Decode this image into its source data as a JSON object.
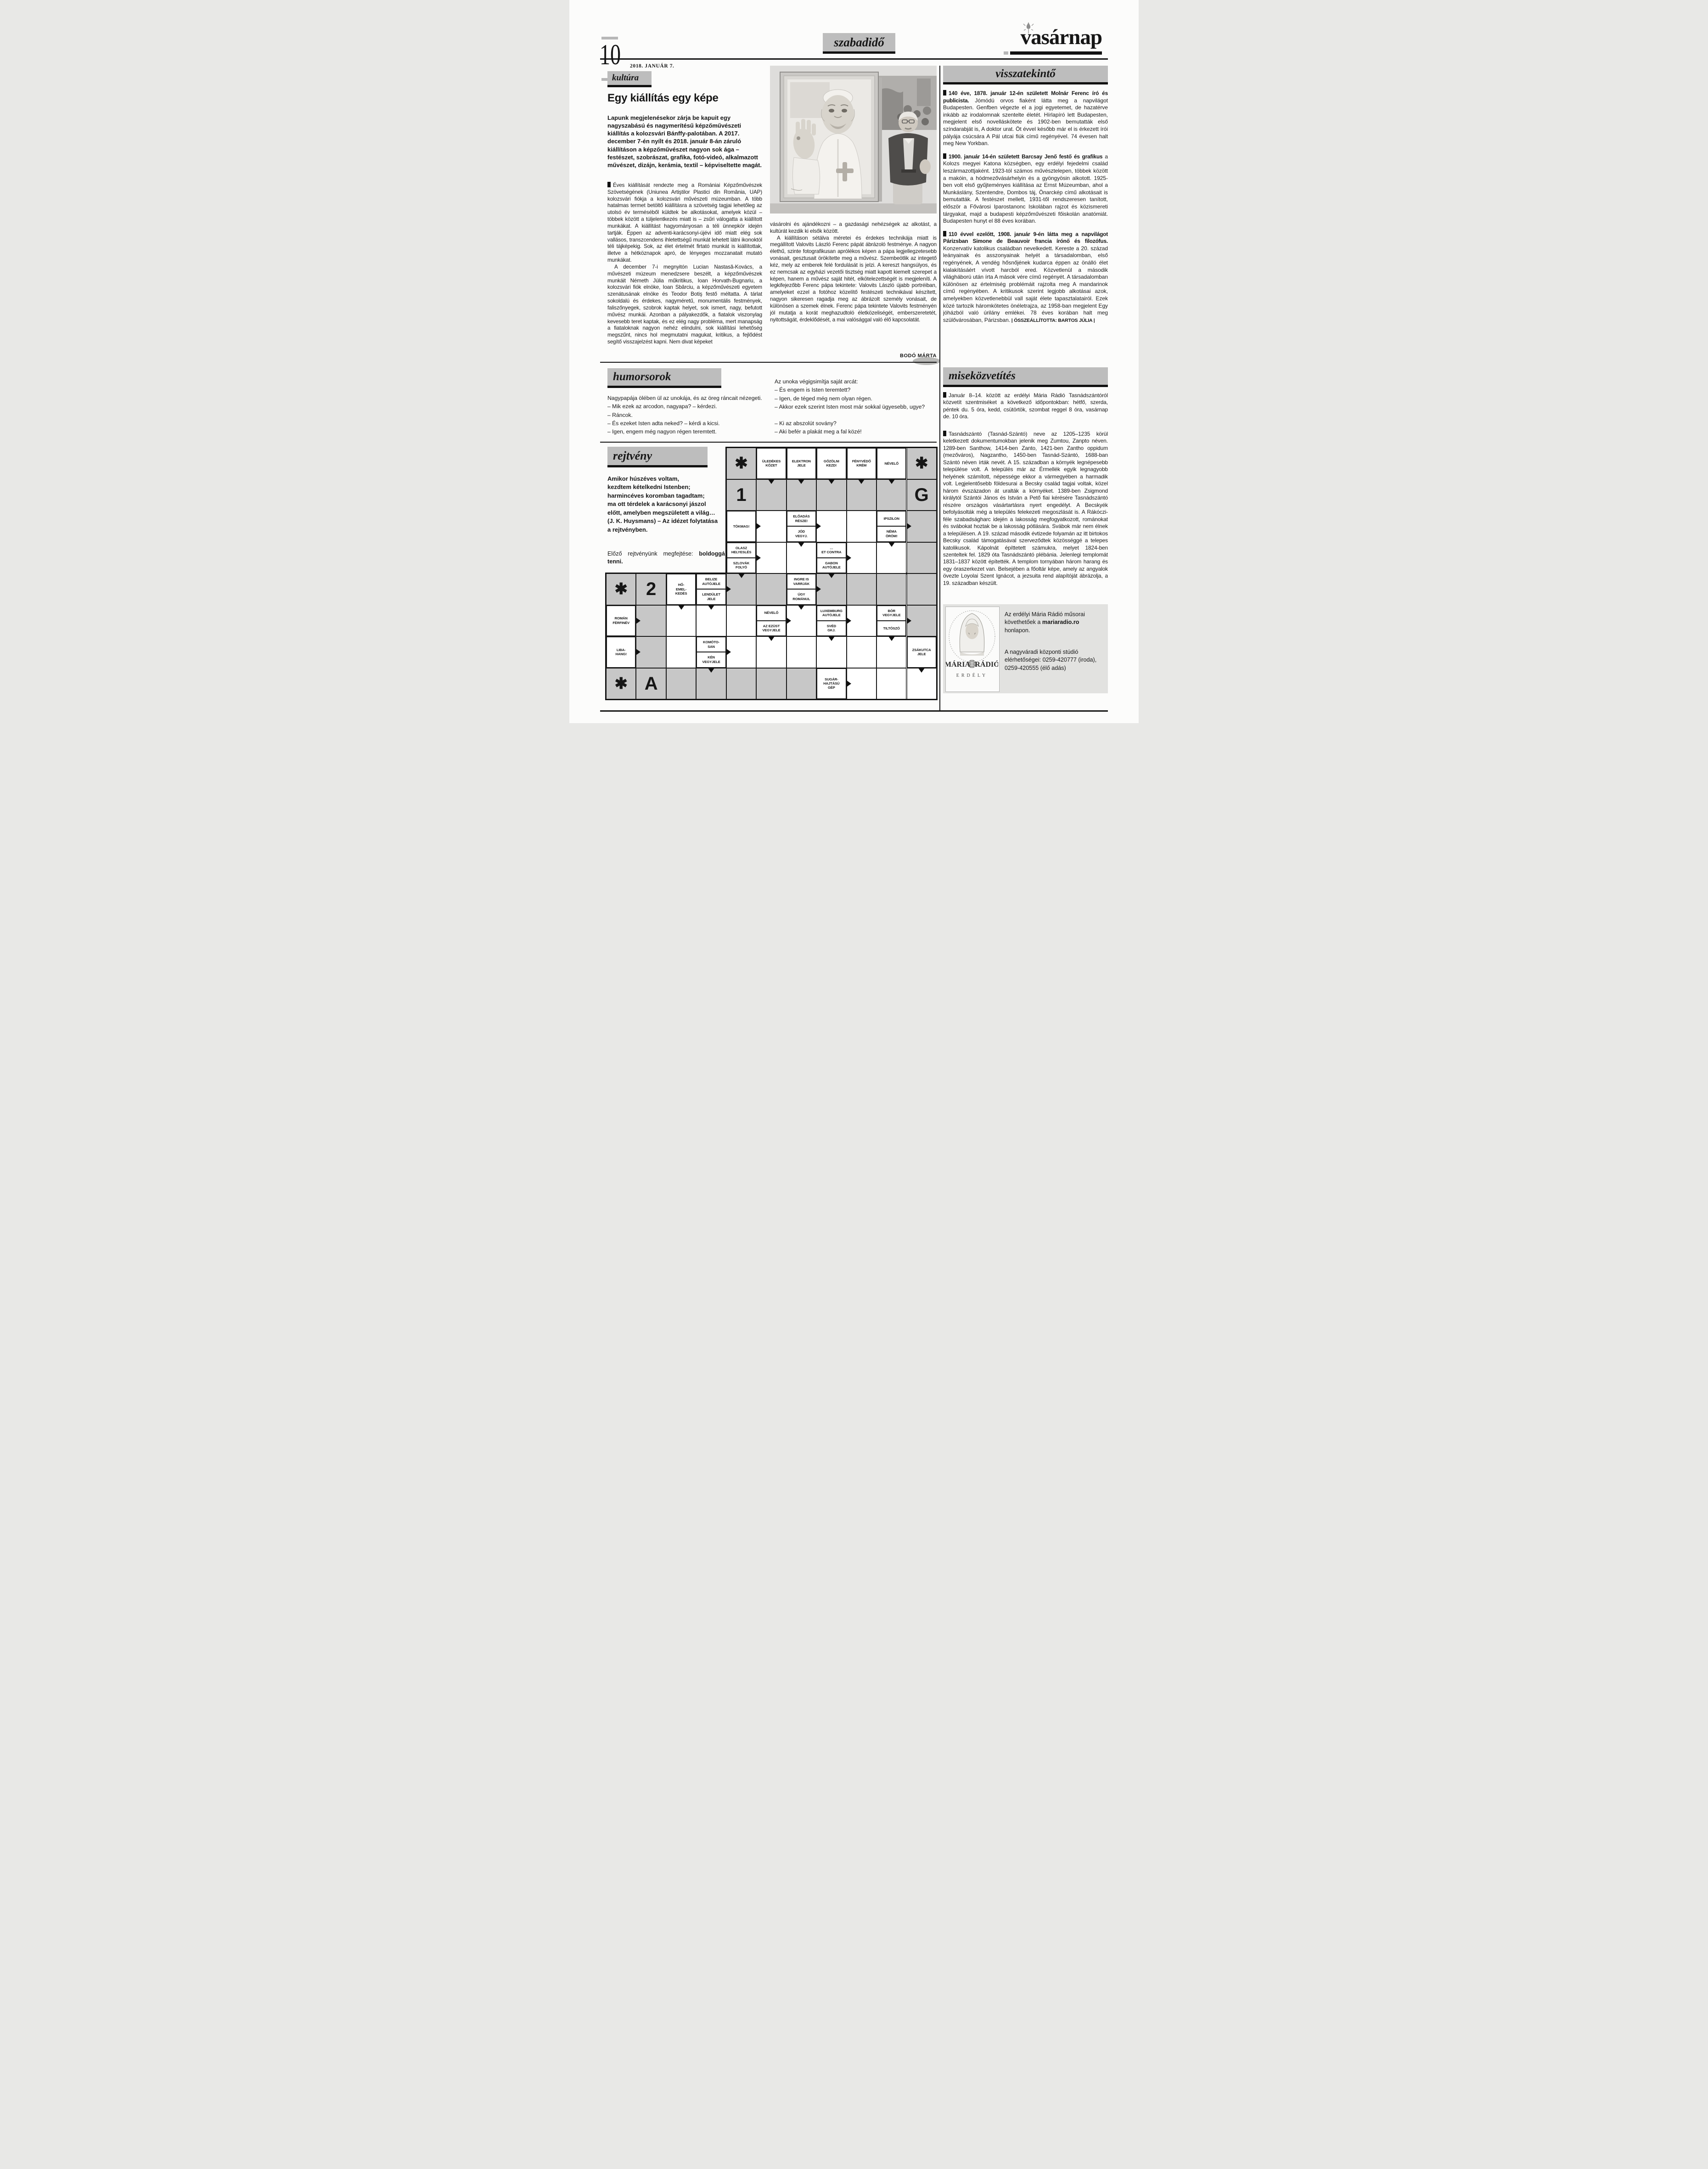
{
  "colors": {
    "header_gray": "#bdbdbd",
    "box_gray": "#d9d9d7",
    "solution_gray": "#c7c7c7",
    "ink": "#161616",
    "paper": "#fcfcfb"
  },
  "header": {
    "page_number": "10",
    "date": "2018. JANUÁR 7.",
    "section_label": "szabadidő",
    "masthead": "vasárnap"
  },
  "article": {
    "label": "kultúra",
    "title": "Egy kiállítás egy képe",
    "lead": "Lapunk megjelenésekor zárja be kapuit egy nagyszabású és nagymerítésű képzőművészeti kiállítás a kolozsvári Bánffy-palotában. A 2017. december 7-én nyílt és 2018. január 8-án záruló kiállításon a képzőművészet nagyon sok ága – festészet, szobrászat, grafika, fotó-videó, alkalmazott művészet, dizájn, kerámia, textil – képviseltette magát.",
    "body1a": "Éves kiállítását rendezte meg a Romániai Képzőművészek Szövetségének (Uniunea Artiştilor Plastici din România, UAP) kolozsvári fiókja a kolozsvári művészeti múzeumban. A több hatalmas termet betöltő kiállításra a szövetség tagjai lehetőleg az utolsó év terméséből küldtek be alkotásokat, amelyek közül – többek között a túljelentkezés miatt is – zsűri válogatta a kiállított munkákat. A kiállítást hagyományosan a téli ünnepkör idején tartják. Éppen az adventi-karácsonyi-újévi idő miatt elég sok vallásos, transzcendens ihletettségű munkát lehetett látni ikonoktól téli tájképekig. Sok, az élet értelmét firtató munkát is kiállítottak, illetve a hétköznapok apró, de lényeges mozzanatait mutató munkákat.",
    "body1b": "A december 7-i megnyitón Lucian Nastasă-Kovács, a művészeti múzeum menedzsere beszélt, a képzőművészek munkáit Németh Júlia műkritikus, Ioan Horvath-Bugnariu, a kolozsvári fiók elnöke, Ioan Sbârciu, a képzőművészeti egyetem szenátusának elnöke és Teodor Botiş festő méltatta. A tárlat sokoldalú és érdekes, nagyméretű, monumentális festmények, faliszőnyegek, szobrok kaptak helyet, sok ismert, nagy, befutott művész munkái. Azonban a pályakezdők, a fiatalok viszonylag kevesebb teret kaptak, és ez elég nagy probléma, mert manapság a fiataloknak nagyon nehéz elindulni, sok kiállítási lehetőség megszűnt, nincs hol megmutatni magukat, kritikus, a fejlődést segítő visszajelzést kapni. Nem divat képeket",
    "body2a": "vásárolni és ajándékozni – a gazdasági nehézségek az alkotást, a kultúrát kezdik ki elsők között.",
    "body2b": "A kiállításon sétálva méretei és érdekes technikája miatt is megállított Valovits László Ferenc pápát ábrázoló festménye. A nagyon élethű, szinte fotografikusan aprólékos képen a pápa legjellegzetesebb vonásait, gesztusait örökítette meg a művész. Szembeötlik az integető kéz, mely az emberek felé fordulását is jelzi. A kereszt hangsúlyos, és ez nemcsak az egyházi vezetői tisztség miatt kapott kiemelt szerepet a képen, hanem a művész saját hitét, elkötelezettségét is megjeleníti. A legkifejezőbb Ferenc pápa tekintete: Valovits László újabb portréiban, amelyeket ezzel a fotóhoz közelítő festészeti technikával készített, nagyon sikeresen ragadja meg az ábrázolt személy vonásait, de különösen a szemek élnek. Ferenc pápa tekintete Valovits festményén jól mutatja a korát meghazudtoló életközeliségét, emberszeretetét, nyitottságát, érdeklődését, a mai valósággal való élő kapcsolatát.",
    "byline": "BODÓ MÁRTA"
  },
  "visszatekinto": {
    "label": "visszatekintő",
    "items": [
      {
        "bold": "140 éve, 1878. január 12-én született Molnár Ferenc író és publicista.",
        "text": " Jómódú orvos fiaként látta meg a napvilágot Budapesten. Genfben végezte el a jogi egyetemet, de hazatérve inkább az irodalomnak szentelte életét. Hírlapíró lett Budapesten, megjelent első novelláskötete és 1902-ben bemutatták első színdarabját is, A doktor urat. Öt évvel később már el is érkezett írói pályája csúcsára A Pál utcai fiúk című regényével. 74 évesen halt meg New Yorkban."
      },
      {
        "bold": "1900. január 14-én született Barcsay Jenő festő és grafikus",
        "text": " a Kolozs megyei Katona községben, egy erdélyi fejedelmi család leszármazottjaként. 1923-tól számos művésztelepen, többek között a makóin, a hódmezővásárhelyin és a gyöngyösin alkotott. 1925-ben volt első gyűjteményes kiállítása az Ernst Múzeumban, ahol a Munkáslány, Szentendre, Dombos táj, Önarckép című alkotásait is bemutatták. A festészet mellett, 1931-től rendszeresen tanított, először a Fővárosi Iparostanonc Iskolában rajzot és közismereti tárgyakat, majd a budapesti képzőművészeti főiskolán anatómiát. Budapesten hunyt el 88 éves korában."
      },
      {
        "bold": "110 évvel ezelőtt, 1908. január 9-én látta meg a napvilágot Párizsban Simone de Beauvoir francia írónő és filozófus.",
        "text": " Konzervatív katolikus családban nevelkedett. Kereste a 20. század leányainak és asszonyainak helyét a társadalomban, első regényének, A vendég hősnőjének kudarca éppen az önálló élet kialakításáért vívott harcból ered. Közvetlenül a második világháború után írta A mások vére című regényét. A társadalomban különösen az értelmiség problémáit rajzolta meg A mandarinok című regényében. A kritikusok szerint legjobb alkotásai azok, amelyekben közvetlenebbül vall saját élete tapasztalatairól. Ezek közé tartozik háromkötetes önéletrajza, az 1958-ban megjelent Egy jóházból való úrilány emlékei. 78 éves korában halt meg szülővárosában, Párizsban.",
        "credit": "ÖSSZEÁLLÍTOTTA: BARTOS JÚLIA"
      }
    ]
  },
  "humor": {
    "label": "humorsorok",
    "left": [
      "Nagypapája ölében ül az unokája, és az öreg ráncait nézegeti.",
      "– Mik ezek az arcodon, nagyapa? – kérdezi.",
      "– Ráncok.",
      "– És ezeket Isten adta neked? – kérdi a kicsi.",
      "– Igen, engem még nagyon régen teremtett."
    ],
    "right": [
      "Az unoka végigsimítja saját arcát:",
      "– És engem is Isten teremtett?",
      "– Igen, de téged még nem olyan régen.",
      "– Akkor ezek szerint Isten most már sokkal ügyesebb, ugye?",
      "",
      "– Ki az abszolút sovány?",
      "– Aki befér a plakát meg a fal közé!"
    ]
  },
  "mise": {
    "label": "miseközvetítés",
    "p1": "Január 8–14. között az erdélyi Mária Rádió Tasnádszántóról közvetít szentmiséket a következő időpontokban: hétfő, szerda, péntek du. 5 óra, kedd, csütörtök, szombat reggel 8 óra, vasárnap de. 10 óra.",
    "p2": "Tasnádszántó (Tasnád-Szántó) neve az 1205–1235 körül keletkezett dokumentumokban jelenik meg Zumtou, Zanpto néven. 1289-ben Santhow, 1414-ben Zanto, 1421-ben Zantho oppidum (mezőváros), Nagzantho, 1450-ben Tasnád-Szántó, 1688-ban Szántó néven írták nevét. A 15. században a környék legnépesebb települése volt. A település már az Érmellék egyik legnagyobb helyének számított, népessége ekkor a vármegyében a harmadik volt. Legjelentősebb földesurai a Becsky család tagjai voltak, közel három évszázadon át uralták a környéket. 1389-ben Zsigmond királytól Szántói János és István a Pető fiai kérésére Tasnádszántó részére országos vásártartásra nyert engedélyt. A Becskyék befolyásolták még a település felekezeti megoszlását is. A Rákóczi-féle szabadságharc idején a lakosság megfogyatkozott, románokat és svábokat hoztak be a lakosság pótlására. Svábok már nem élnek a településen. A 19. század második évtizede folyamán az itt birtokos Becsky család támogatásával szerveződtek közösséggé a telepes katolikusok. Kápolnát építtetett számukra, melyet 1824-ben szenteltek fel. 1829 óta Tasnádszántó plébánia. Jelenlegi templomát 1831–1837 között építették. A templom tornyában három harang és egy óraszerkezet van. Belsejében a főoltár képe, amely az angyalok övezte Loyolai Szent Ignácot, a jezsuita rend alapítóját ábrázolja, a 19. században készült.",
    "radio": {
      "t1a": "Az erdélyi Mária Rádió műsorai követhetőek a ",
      "t1b": "mariaradio.ro",
      "t1c": " honlapon.",
      "t2": "A nagyváradi központi stúdió elérhetőségei: 0259-420777 (iroda), 0259-420555 (élő adás)",
      "logo_left": "MÁRIA",
      "logo_right": "RÁDIÓ",
      "logo_region": "ERDÉLY"
    }
  },
  "rejtveny": {
    "label": "rejtvény",
    "quote_lines": [
      "Amikor húszéves voltam,",
      "kezdtem kételkedni Istenben;",
      "harmincéves koromban tagadtam;",
      "ma ott térdelek a karácsonyi jászol",
      "előtt, amelyben megszületett a világ…",
      "(J. K. Huysmans) – Az idézet folytatása",
      "a rejtvényben."
    ],
    "prev_label": "Előző rejtvényünk megfejtése: ",
    "prev_bold": "boldoggá tenni."
  },
  "crossword": {
    "cells": [
      {
        "r": 0,
        "c": 4,
        "t": "sym",
        "sym": "✱"
      },
      {
        "r": 0,
        "c": 5,
        "t": "clue",
        "txt": "ÜLEDÉKES\nKŐZET"
      },
      {
        "r": 0,
        "c": 6,
        "t": "clue",
        "txt": "ELEKTRON\nJELE"
      },
      {
        "r": 0,
        "c": 7,
        "t": "clue",
        "txt": "GŐZÖLNI\nKEZD!"
      },
      {
        "r": 0,
        "c": 8,
        "t": "clue",
        "txt": "FÉNYVÉDŐ\nKRÉM"
      },
      {
        "r": 0,
        "c": 9,
        "t": "clue",
        "txt": "NÉVELŐ"
      },
      {
        "r": 0,
        "c": 10,
        "t": "sym",
        "sym": "✱"
      },
      {
        "r": 1,
        "c": 4,
        "t": "sym",
        "sym": "1"
      },
      {
        "r": 1,
        "c": 5,
        "t": "gray",
        "arr": [
          "d"
        ]
      },
      {
        "r": 1,
        "c": 6,
        "t": "gray",
        "arr": [
          "d"
        ]
      },
      {
        "r": 1,
        "c": 7,
        "t": "gray",
        "arr": [
          "d"
        ]
      },
      {
        "r": 1,
        "c": 8,
        "t": "gray",
        "arr": [
          "d"
        ]
      },
      {
        "r": 1,
        "c": 9,
        "t": "gray",
        "arr": [
          "d"
        ]
      },
      {
        "r": 1,
        "c": 10,
        "t": "sym",
        "sym": "G"
      },
      {
        "r": 2,
        "c": 4,
        "t": "clue",
        "txt": "TÖKMAG!"
      },
      {
        "r": 2,
        "c": 5,
        "t": "white",
        "arr": [
          "r"
        ]
      },
      {
        "r": 2,
        "c": 6,
        "t": "clue2",
        "l1": "ELŐADÁS\nRÉSZE!",
        "l2": "JÓD\nVEGYJ."
      },
      {
        "r": 2,
        "c": 7,
        "t": "white",
        "arr": [
          "r"
        ]
      },
      {
        "r": 2,
        "c": 8,
        "t": "white"
      },
      {
        "r": 2,
        "c": 9,
        "t": "clue2",
        "l1": "IPSZILON",
        "l2": "NÉMA\nÖRÖM!"
      },
      {
        "r": 2,
        "c": 10,
        "t": "gray",
        "arr": [
          "r"
        ]
      },
      {
        "r": 3,
        "c": 4,
        "t": "clue2",
        "l1": "OLASZ\nHELYESLÉS",
        "l2": "SZLOVÁK\nFOLYÓ"
      },
      {
        "r": 3,
        "c": 5,
        "t": "white",
        "arr": [
          "r"
        ]
      },
      {
        "r": 3,
        "c": 6,
        "t": "white",
        "arr": [
          "d"
        ]
      },
      {
        "r": 3,
        "c": 7,
        "t": "clue2",
        "l1": "…\nET CONTRA",
        "l2": "GABON\nAUTÓJELE"
      },
      {
        "r": 3,
        "c": 8,
        "t": "white",
        "arr": [
          "r"
        ]
      },
      {
        "r": 3,
        "c": 9,
        "t": "white",
        "arr": [
          "d"
        ]
      },
      {
        "r": 3,
        "c": 10,
        "t": "gray"
      },
      {
        "r": 4,
        "c": 0,
        "t": "sym",
        "sym": "✱"
      },
      {
        "r": 4,
        "c": 1,
        "t": "sym",
        "sym": "2"
      },
      {
        "r": 4,
        "c": 2,
        "t": "clue",
        "txt": "HŐ-\nEMEL-\nKEDÉS"
      },
      {
        "r": 4,
        "c": 3,
        "t": "clue2",
        "l1": "BELIZE\nAUTÓJELE",
        "l2": "LENDÜLET\nJELE"
      },
      {
        "r": 4,
        "c": 4,
        "t": "gray",
        "arr": [
          "r",
          "d"
        ]
      },
      {
        "r": 4,
        "c": 5,
        "t": "gray"
      },
      {
        "r": 4,
        "c": 6,
        "t": "clue2",
        "l1": "INGRE IS\nVARRJÁK",
        "l2": "ÚGY\nROMÁNUL"
      },
      {
        "r": 4,
        "c": 7,
        "t": "gray",
        "arr": [
          "r",
          "d"
        ]
      },
      {
        "r": 4,
        "c": 8,
        "t": "gray"
      },
      {
        "r": 4,
        "c": 9,
        "t": "gray"
      },
      {
        "r": 4,
        "c": 10,
        "t": "gray"
      },
      {
        "r": 5,
        "c": 0,
        "t": "clue",
        "txt": "ROMÁN\nFÉRFINÉV"
      },
      {
        "r": 5,
        "c": 1,
        "t": "gray",
        "arr": [
          "r"
        ]
      },
      {
        "r": 5,
        "c": 2,
        "t": "white",
        "arr": [
          "d"
        ]
      },
      {
        "r": 5,
        "c": 3,
        "t": "white",
        "arr": [
          "d"
        ]
      },
      {
        "r": 5,
        "c": 4,
        "t": "white"
      },
      {
        "r": 5,
        "c": 5,
        "t": "clue2",
        "l1": "NÉVELŐ",
        "l2": "AZ EZÜST\nVEGYJELE"
      },
      {
        "r": 5,
        "c": 6,
        "t": "white",
        "arr": [
          "r",
          "d"
        ]
      },
      {
        "r": 5,
        "c": 7,
        "t": "clue2",
        "l1": "LUXEMBURG\nAUTÓJELE",
        "l2": "SVÉD\nGKJ."
      },
      {
        "r": 5,
        "c": 8,
        "t": "white",
        "arr": [
          "r"
        ]
      },
      {
        "r": 5,
        "c": 9,
        "t": "clue2",
        "l1": "BÓR\nVEGYJELE",
        "l2": "TILTÓSZÓ"
      },
      {
        "r": 5,
        "c": 10,
        "t": "gray",
        "arr": [
          "r"
        ]
      },
      {
        "r": 6,
        "c": 0,
        "t": "clue",
        "txt": "LIBA-\nHANG!"
      },
      {
        "r": 6,
        "c": 1,
        "t": "gray",
        "arr": [
          "r"
        ]
      },
      {
        "r": 6,
        "c": 2,
        "t": "white"
      },
      {
        "r": 6,
        "c": 3,
        "t": "clue2",
        "l1": "KOMÓTO-\nSAN",
        "l2": "KÉN\nVEGYJELE"
      },
      {
        "r": 6,
        "c": 4,
        "t": "white",
        "arr": [
          "r"
        ]
      },
      {
        "r": 6,
        "c": 5,
        "t": "white",
        "arr": [
          "d"
        ]
      },
      {
        "r": 6,
        "c": 6,
        "t": "white"
      },
      {
        "r": 6,
        "c": 7,
        "t": "white",
        "arr": [
          "d"
        ]
      },
      {
        "r": 6,
        "c": 8,
        "t": "white"
      },
      {
        "r": 6,
        "c": 9,
        "t": "white",
        "arr": [
          "d"
        ]
      },
      {
        "r": 6,
        "c": 10,
        "t": "clue",
        "txt": "ZSÁKUTCA\nJELE"
      },
      {
        "r": 7,
        "c": 0,
        "t": "sym",
        "sym": "✱"
      },
      {
        "r": 7,
        "c": 1,
        "t": "sym",
        "sym": "A"
      },
      {
        "r": 7,
        "c": 2,
        "t": "gray"
      },
      {
        "r": 7,
        "c": 3,
        "t": "gray",
        "arr": [
          "d"
        ]
      },
      {
        "r": 7,
        "c": 4,
        "t": "gray"
      },
      {
        "r": 7,
        "c": 5,
        "t": "gray"
      },
      {
        "r": 7,
        "c": 6,
        "t": "gray"
      },
      {
        "r": 7,
        "c": 7,
        "t": "clue",
        "txt": "SUGÁR-\nHAJTÁSÚ\nGÉP"
      },
      {
        "r": 7,
        "c": 8,
        "t": "white",
        "arr": [
          "r"
        ]
      },
      {
        "r": 7,
        "c": 9,
        "t": "white"
      },
      {
        "r": 7,
        "c": 10,
        "t": "white",
        "arr": [
          "d"
        ]
      }
    ]
  }
}
